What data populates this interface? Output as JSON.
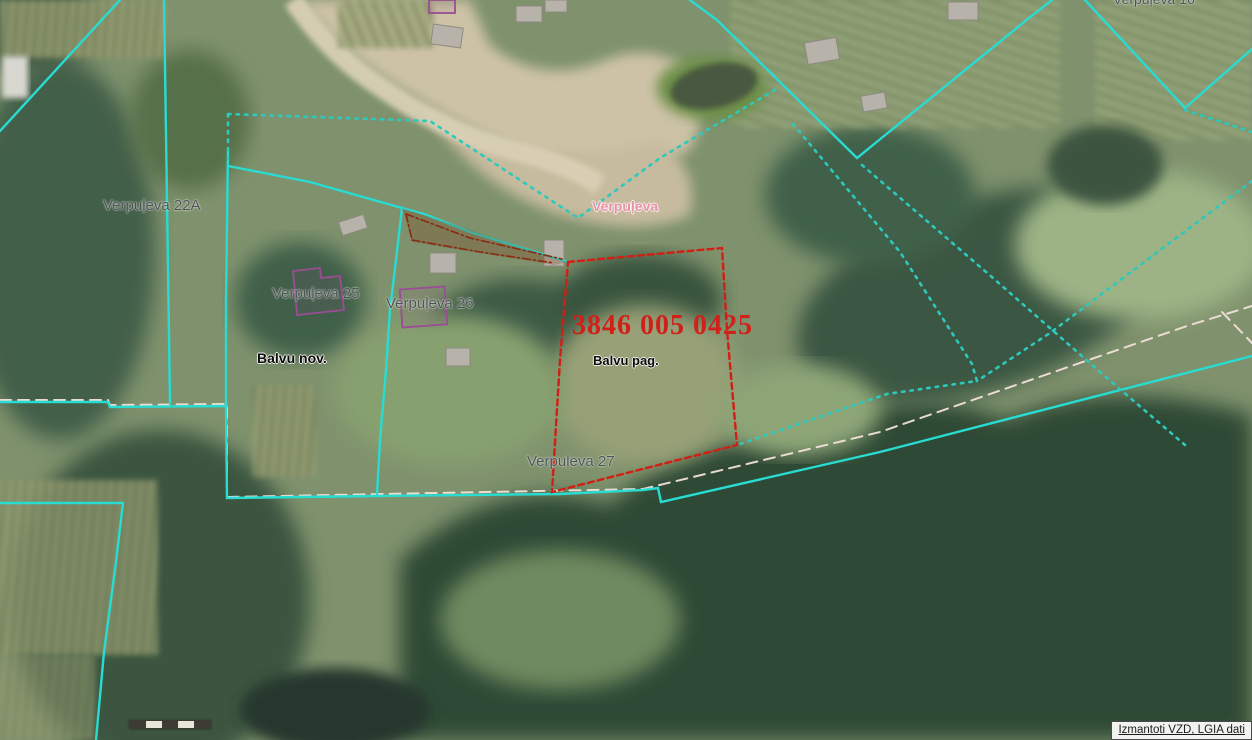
{
  "map": {
    "labels": {
      "verpuleva_22a": "Verpuļeva 22A",
      "verpuleva_25": "Verpuļeva 25",
      "verpuleva_26": "Verpuļeva 26",
      "verpuleva_27": "Verpuļeva 27",
      "verpuleva_road": "Verpuļeva",
      "verpuleva_top_clipped": "Verpuļeva 16",
      "municipality": "Balvu nov.",
      "parish": "Balvu pag."
    },
    "selected_parcel": {
      "cadastre_number": "3846 005 0425"
    },
    "attribution": "Izmantoti VZD, LGIA dati",
    "colors": {
      "cadastral_boundary_cyan": "#29dcd2",
      "cadastral_boundary_dotted": "#2cc9bc",
      "selected_parcel_red": "#d21e14",
      "admin_boundary_pink": "#f3e0da",
      "building_outline_purple": "#9a4d95",
      "road_label_pink": "#e891a8"
    }
  }
}
